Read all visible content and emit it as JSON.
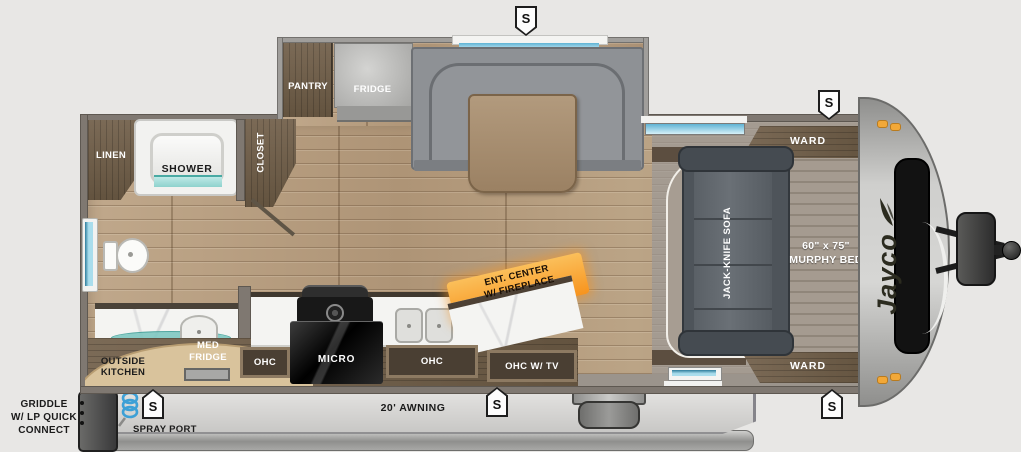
{
  "brand": "Jayco",
  "markers": {
    "speaker": "S"
  },
  "slideout": {
    "pantry": "PANTRY",
    "fridge": "FRIDGE"
  },
  "bathroom": {
    "linen": "LINEN",
    "shower": "SHOWER",
    "closet": "CLOSET"
  },
  "bedroom": {
    "ward_top": "WARD",
    "ward_bottom": "WARD",
    "sofa": "JACK-KNIFE SOFA",
    "bed_size": "60\" x 75\"",
    "bed_name": "MURPHY BED"
  },
  "kitchen": {
    "outside_kitchen_line1": "OUTSIDE",
    "outside_kitchen_line2": "KITCHEN",
    "med_fridge_line1": "MED",
    "med_fridge_line2": "FRIDGE",
    "ohc_left": "OHC",
    "micro": "MICRO",
    "ohc_center": "OHC",
    "ohc_tv": "OHC W/ TV",
    "ent_center_line1": "ENT. CENTER",
    "ent_center_line2": "W/ FIREPLACE"
  },
  "exterior": {
    "griddle_line1": "GRIDDLE",
    "griddle_line2": "W/ LP QUICK",
    "griddle_line3": "CONNECT",
    "spray_port": "SPRAY PORT",
    "awning": "20' AWNING"
  },
  "colors": {
    "accent_orange": "#f7941e",
    "window_glass": "#a9ddec",
    "teal_glass": "#7fc8c2",
    "amber_marker": "#f2a838",
    "wood_floor": "#b59c7f",
    "dark_wood": "#6e5e4c",
    "sofa_gray": "#565c62",
    "counter_white": "#f4f4f2"
  }
}
